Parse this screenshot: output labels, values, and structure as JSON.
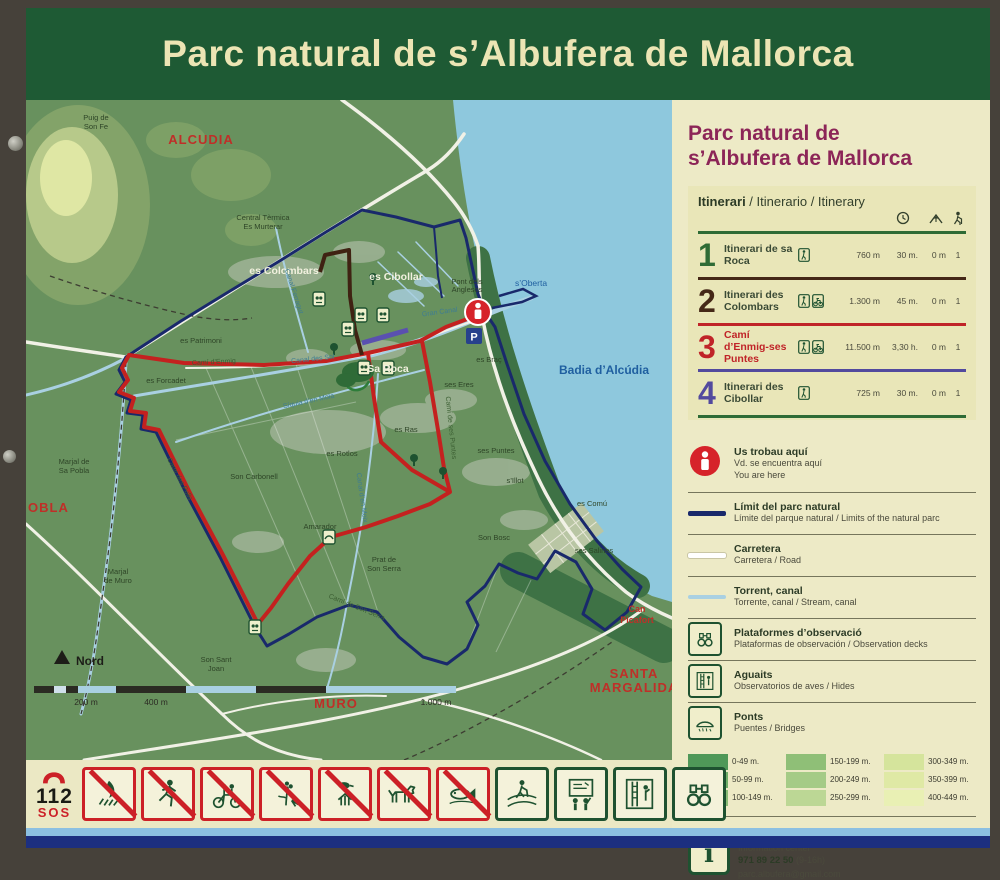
{
  "sign_title": "Parc natural de s’Albufera de Mallorca",
  "panel": {
    "title_line1": "Parc natural de",
    "title_line2": "s’Albufera de Mallorca",
    "itinerary": {
      "header_bold": "Itinerari",
      "header_rest": " / Itinerario / Itinerary",
      "rows": [
        {
          "number": "1",
          "name": "Itinerari de sa Roca",
          "modes": [
            "walk"
          ],
          "distance": "760 m",
          "time": "30 m.",
          "elevation": "0 m",
          "difficulty": "1",
          "color": "#2e6b35"
        },
        {
          "number": "2",
          "name": "Itinerari des Colombars",
          "modes": [
            "walk",
            "bike"
          ],
          "distance": "1.300 m",
          "time": "45 m.",
          "elevation": "0 m",
          "difficulty": "1",
          "color": "#452817"
        },
        {
          "number": "3",
          "name": "Camí d’Enmig-ses Puntes",
          "modes": [
            "walk",
            "bike"
          ],
          "distance": "11.500 m",
          "time": "3,30 h.",
          "elevation": "0 m",
          "difficulty": "1",
          "color": "#c02428"
        },
        {
          "number": "4",
          "name": "Itinerari des Cibollar",
          "modes": [
            "walk"
          ],
          "distance": "725 m",
          "time": "30 m.",
          "elevation": "0 m",
          "difficulty": "1",
          "color": "#524a9e"
        }
      ]
    },
    "legend": [
      {
        "icon": "you-are-here",
        "title": "Us trobau aquí",
        "sub1": "Vd. se encuentra aquí",
        "sub2": "You are here"
      },
      {
        "icon": "park-limit",
        "title": "Límit del parc natural",
        "sub1": "Límite del parque natural / Limits of the natural parc"
      },
      {
        "icon": "road",
        "title": "Carretera",
        "sub1": "Carretera / Road"
      },
      {
        "icon": "stream",
        "title": "Torrent, canal",
        "sub1": "Torrente, canal / Stream, canal"
      },
      {
        "icon": "observation-deck",
        "title": "Plataformes d’observació",
        "sub1": "Plataformas de observación / Observation decks"
      },
      {
        "icon": "hide",
        "title": "Aguaits",
        "sub1": "Observatorios de aves / Hides"
      },
      {
        "icon": "bridge",
        "title": "Ponts",
        "sub1": "Puentes / Bridges"
      }
    ],
    "elevation_scale": {
      "columns": [
        {
          "labels": [
            "0-49 m.",
            "50-99 m.",
            "100-149 m."
          ],
          "colors": [
            "#4f9858",
            "#6fae68",
            "#8abc76"
          ]
        },
        {
          "labels": [
            "150-199 m.",
            "200-249 m.",
            "250-299 m."
          ],
          "colors": [
            "#8fbf77",
            "#a5cb86",
            "#bcd795"
          ]
        },
        {
          "labels": [
            "300-349 m.",
            "350-399 m.",
            "400-449 m."
          ],
          "colors": [
            "#d5e49c",
            "#dfe9a5",
            "#e9f0b4"
          ]
        }
      ]
    },
    "info": {
      "title_bold": "Centre d’informació",
      "title_rest": " / Centro de información / Information center",
      "phone": "971 89 22 50",
      "hours": " (9-16h)",
      "email": "parc.albufera@gmail.com"
    }
  },
  "map": {
    "labels": [
      {
        "t": "ALCUDIA",
        "x": 175,
        "y": 44,
        "c": "lr"
      },
      {
        "t": "MURO",
        "x": 310,
        "y": 608,
        "c": "lr"
      },
      {
        "t": "SANTA",
        "x": 608,
        "y": 578,
        "c": "lr"
      },
      {
        "t": "MARGALIDA",
        "x": 608,
        "y": 592,
        "c": "lr"
      },
      {
        "t": "OBLA",
        "x": 2,
        "y": 412,
        "c": "lr",
        "a": "start"
      },
      {
        "t": "Can",
        "x": 611,
        "y": 512,
        "c": "lr2"
      },
      {
        "t": "Picafort",
        "x": 611,
        "y": 523,
        "c": "lr2"
      },
      {
        "t": "Badia d’Alcúdia",
        "x": 578,
        "y": 274,
        "c": "lb"
      },
      {
        "t": "s’Oberta",
        "x": 505,
        "y": 186,
        "c": "lb2"
      },
      {
        "t": "Pont dels",
        "x": 441,
        "y": 184,
        "c": "ld"
      },
      {
        "t": "Anglesos",
        "x": 441,
        "y": 192,
        "c": "ld"
      },
      {
        "t": "Gran Canal",
        "x": 414,
        "y": 214,
        "c": "lcan",
        "r": -8
      },
      {
        "t": "es Colombars",
        "x": 258,
        "y": 174,
        "c": "lw"
      },
      {
        "t": "es Cibollar",
        "x": 370,
        "y": 180,
        "c": "lw"
      },
      {
        "t": "Sa Roca",
        "x": 362,
        "y": 272,
        "c": "lw"
      },
      {
        "t": "es Patrimoni",
        "x": 175,
        "y": 243,
        "c": "ld"
      },
      {
        "t": "es Forcadet",
        "x": 140,
        "y": 283,
        "c": "ld"
      },
      {
        "t": "Son Carbonell",
        "x": 228,
        "y": 379,
        "c": "ld"
      },
      {
        "t": "es Rotlos",
        "x": 316,
        "y": 356,
        "c": "ld"
      },
      {
        "t": "es Ras",
        "x": 380,
        "y": 332,
        "c": "ld"
      },
      {
        "t": "ses Eres",
        "x": 433,
        "y": 287,
        "c": "ld"
      },
      {
        "t": "es Braç",
        "x": 463,
        "y": 262,
        "c": "ld"
      },
      {
        "t": "ses Puntes",
        "x": 470,
        "y": 353,
        "c": "ld"
      },
      {
        "t": "s’Illot",
        "x": 489,
        "y": 383,
        "c": "ld"
      },
      {
        "t": "es Comú",
        "x": 566,
        "y": 406,
        "c": "ld"
      },
      {
        "t": "ses Salines",
        "x": 568,
        "y": 453,
        "c": "ld"
      },
      {
        "t": "Amarador",
        "x": 294,
        "y": 429,
        "c": "ld"
      },
      {
        "t": "Prat de",
        "x": 358,
        "y": 462,
        "c": "ld"
      },
      {
        "t": "Son Serra",
        "x": 358,
        "y": 471,
        "c": "ld"
      },
      {
        "t": "Son Bosc",
        "x": 468,
        "y": 440,
        "c": "ld"
      },
      {
        "t": "Marjal de",
        "x": 48,
        "y": 364,
        "c": "ld"
      },
      {
        "t": "Sa Pobla",
        "x": 48,
        "y": 373,
        "c": "ld"
      },
      {
        "t": "Marjal",
        "x": 92,
        "y": 474,
        "c": "ld"
      },
      {
        "t": "de Muro",
        "x": 92,
        "y": 483,
        "c": "ld"
      },
      {
        "t": "Son Sant",
        "x": 190,
        "y": 562,
        "c": "ld"
      },
      {
        "t": "Joan",
        "x": 190,
        "y": 571,
        "c": "ld"
      },
      {
        "t": "Central Tèrmica",
        "x": 237,
        "y": 120,
        "c": "ld"
      },
      {
        "t": "Es Murterar",
        "x": 237,
        "y": 129,
        "c": "ld"
      },
      {
        "t": "Puig de",
        "x": 70,
        "y": 20,
        "c": "ld"
      },
      {
        "t": "Son Fe",
        "x": 70,
        "y": 29,
        "c": "ld"
      },
      {
        "t": "Camí d’Enmig",
        "x": 188,
        "y": 264,
        "c": "lpath",
        "r": -3
      },
      {
        "t": "Canal des Sol",
        "x": 287,
        "y": 261,
        "c": "lcan",
        "r": -6
      },
      {
        "t": "Síquia d’en Mola",
        "x": 283,
        "y": 303,
        "c": "lcan",
        "r": -12
      },
      {
        "t": "Camí des Polls",
        "x": 152,
        "y": 380,
        "c": "lpath",
        "r": 62
      },
      {
        "t": "Canal d’en Moix",
        "x": 334,
        "y": 398,
        "c": "lcan",
        "r": 82
      },
      {
        "t": "Camí de ses Puntes",
        "x": 423,
        "y": 328,
        "c": "lpath",
        "r": 84
      },
      {
        "t": "Canal Ferragut",
        "x": 266,
        "y": 192,
        "c": "lcan",
        "r": 72
      },
      {
        "t": "Camí de Son Serra",
        "x": 330,
        "y": 509,
        "c": "lpath",
        "r": 22
      }
    ],
    "north_label": "Nord",
    "scale_labels": [
      "200 m",
      "400 m",
      "1.000 m"
    ],
    "parking_label": "P"
  },
  "footer": {
    "emergency_number": "112",
    "emergency_sos": "SOS",
    "prohibited_icons": [
      "no-fire",
      "no-running",
      "no-cycling",
      "no-picking-plants",
      "no-catching-animals",
      "no-dogs",
      "no-fishing"
    ],
    "allowed_icons": [
      "walking-trail",
      "exhibition",
      "observation-hide",
      "binoculars"
    ]
  }
}
